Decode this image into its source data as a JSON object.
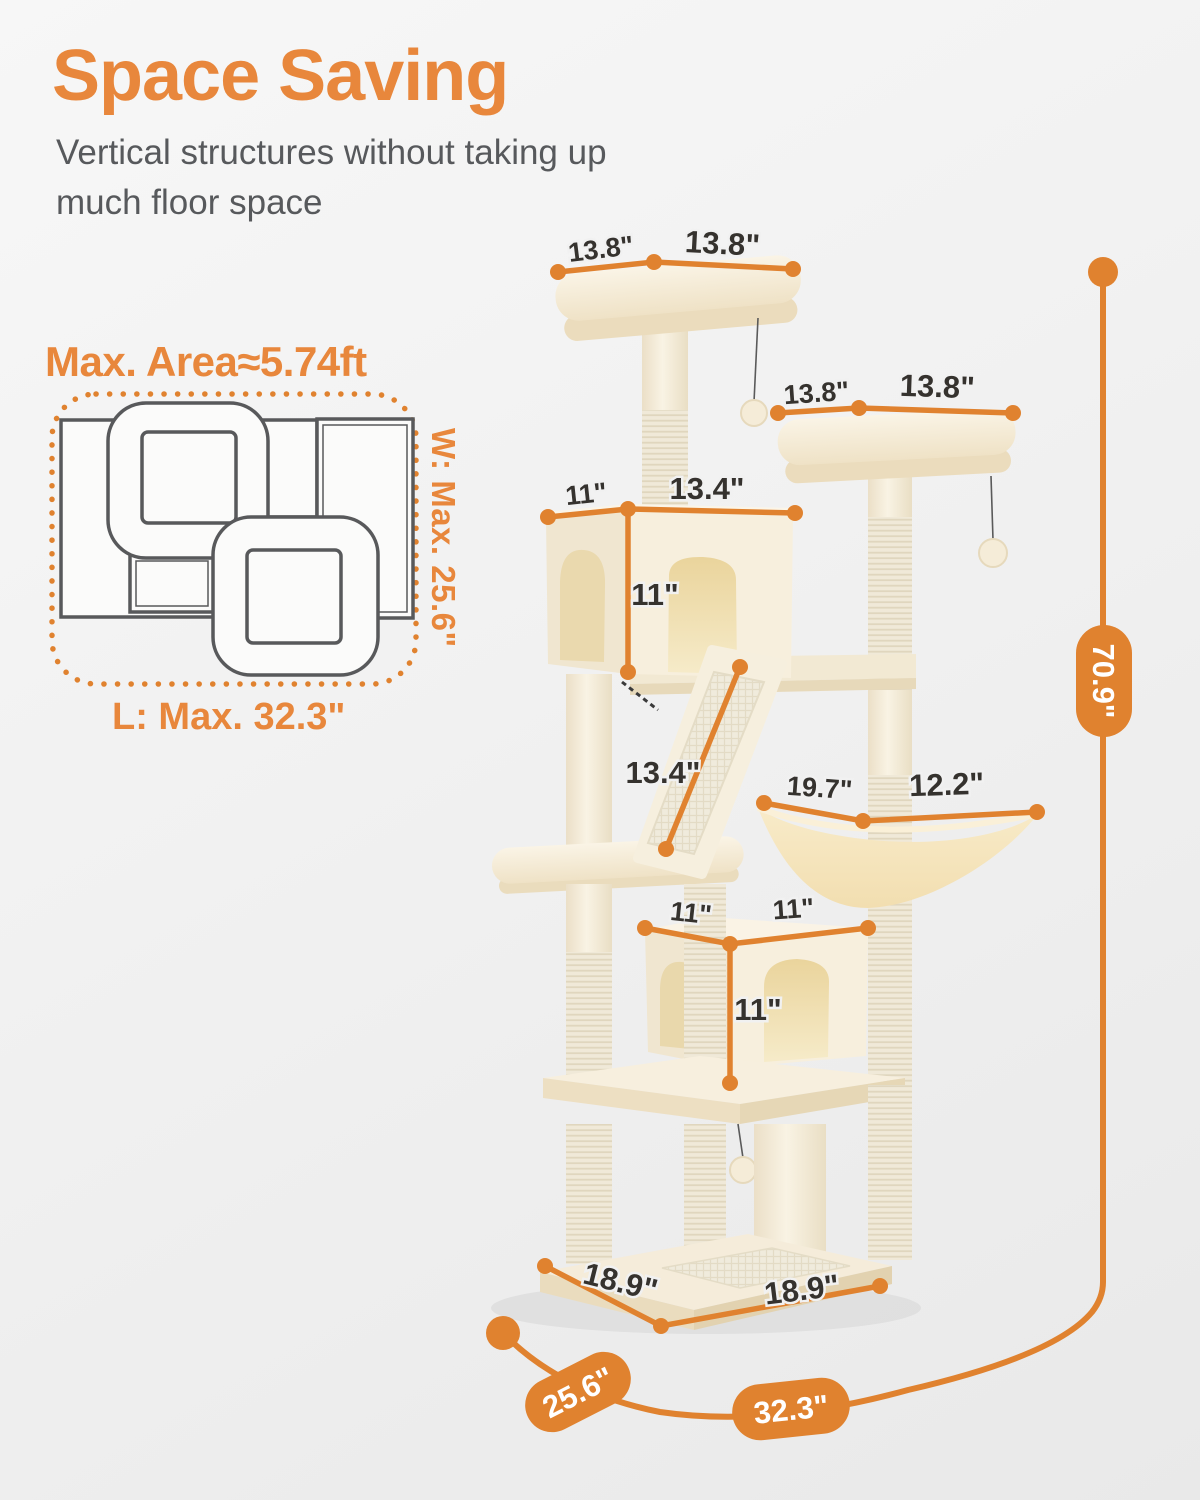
{
  "header": {
    "title": "Space Saving",
    "subtitle_line1": "Vertical structures without taking up",
    "subtitle_line2": "much floor space"
  },
  "footprint": {
    "title": "Max. Area≈5.74ft",
    "width_label": "W: Max. 25.6\"",
    "length_label": "L: Max. 32.3\""
  },
  "annotations": {
    "top_perch": {
      "left": "13.8\"",
      "right": "13.8\""
    },
    "second_perch": {
      "left": "13.8\"",
      "right": "13.8\""
    },
    "upper_condo": {
      "width_left": "11\"",
      "width_right": "13.4\"",
      "height": "11\""
    },
    "ramp": {
      "length": "13.4\""
    },
    "hammock": {
      "left": "19.7\"",
      "right": "12.2\""
    },
    "lower_condo": {
      "width_left": "11\"",
      "width_right": "11\"",
      "height": "11\""
    },
    "base": {
      "left": "18.9\"",
      "right": "18.9\""
    },
    "overall": {
      "height": "70.9\"",
      "width": "25.6\"",
      "length": "32.3\""
    }
  },
  "colors": {
    "accent_orange": "#E0822F",
    "title_orange": "#E8873C",
    "subtitle_gray": "#57595C",
    "label_dark": "#35322E",
    "tree_cream": "#F5EDDA",
    "condo_interior": "#EDD9A8"
  }
}
